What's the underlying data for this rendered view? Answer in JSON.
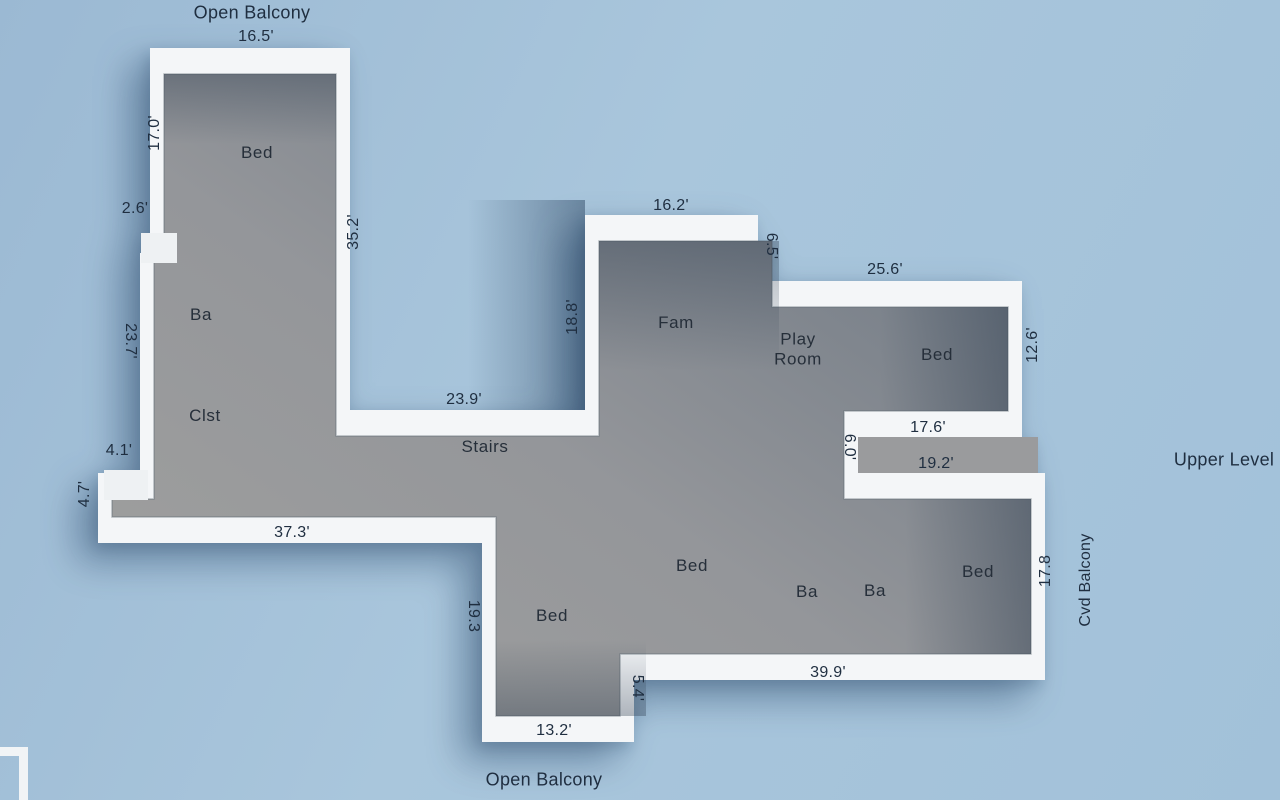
{
  "plan": {
    "level_label": "Upper Level",
    "type": "3d-floorplan"
  },
  "colors": {
    "background": "#a3c1d9",
    "walls": "#f4f6f8",
    "floor_light": "#a1a19f",
    "floor_dark": "#67727f",
    "label_text": "#1f2e40",
    "shadow": "rgba(25,55,90,0.38)"
  },
  "labels": {
    "open_balcony_top": "Open Balcony",
    "open_balcony_bottom": "Open Balcony",
    "cvd_balcony": "Cvd Balcony",
    "upper_level": "Upper Level",
    "rooms": {
      "bed_nw": "Bed",
      "ba_w": "Ba",
      "clst": "Clst",
      "stairs": "Stairs",
      "fam": "Fam",
      "play_room": "Play Room",
      "bed_ne": "Bed",
      "bed_s_mid": "Bed",
      "bed_sw": "Bed",
      "ba_s1": "Ba",
      "ba_s2": "Ba",
      "bed_se": "Bed"
    },
    "dims": {
      "d16_5": "16.5'",
      "d17_0": "17.0'",
      "d2_6": "2.6'",
      "d23_7": "23.7'",
      "d4_1": "4.1'",
      "d4_7": "4.7'",
      "d37_3": "37.3'",
      "d35_2": "35.2'",
      "d23_9": "23.9'",
      "d18_8": "18.8'",
      "d16_2": "16.2'",
      "d6_5": "6.5'",
      "d25_6": "25.6'",
      "d12_6": "12.6'",
      "d17_6": "17.6'",
      "d19_2": "19.2'",
      "d6_0": "6.0'",
      "d17_8": "17.8",
      "d39_9": "39.9'",
      "d5_4": "5.4'",
      "d19_3": "19.3",
      "d13_2": "13.2'"
    }
  }
}
